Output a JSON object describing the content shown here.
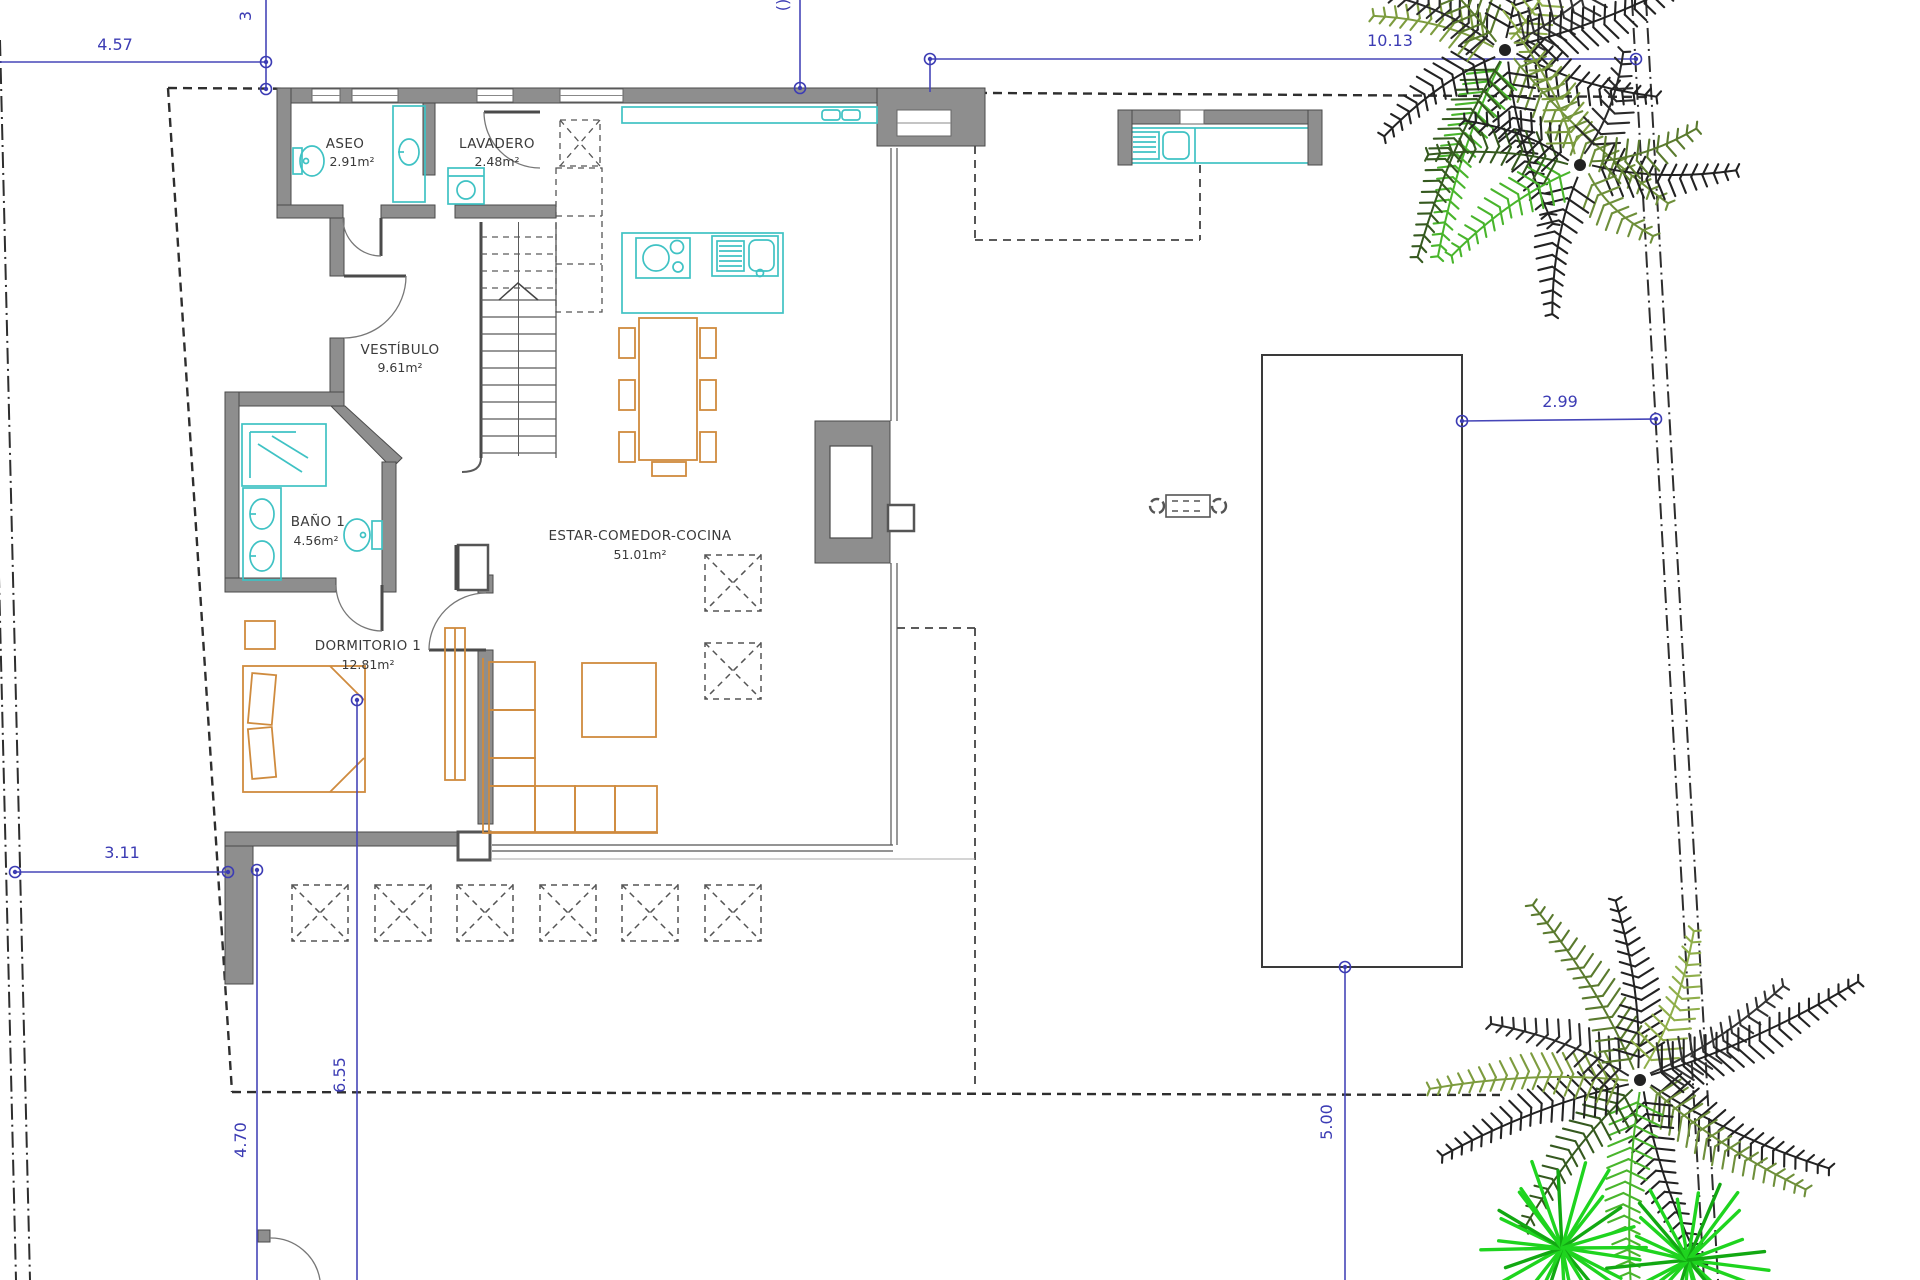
{
  "drawing": {
    "kind": "architectural floor plan",
    "floor": "ground floor villa with plot, terrace and pool"
  },
  "rooms": {
    "aseo": {
      "name": "ASEO",
      "area": "2.91m²"
    },
    "lavadero": {
      "name": "LAVADERO",
      "area": "2.48m²"
    },
    "vestibulo": {
      "name": "VESTÍBULO",
      "area": "9.61m²"
    },
    "bano1": {
      "name": "BAÑO 1",
      "area": "4.56m²"
    },
    "dormitorio1": {
      "name": "DORMITORIO 1",
      "area": "12.81m²"
    },
    "estar": {
      "name": "ESTAR-COMEDOR-COCINA",
      "area": "51.01m²"
    }
  },
  "dimensions": {
    "front_width": "4.57",
    "front_side": "3",
    "rear_width": "10.13",
    "pool_to_boundary": "2.99",
    "side_setback": "3.11",
    "terrace_depth": "6.55",
    "front_setback": "4.70",
    "pool_side": "5.00"
  },
  "colors": {
    "wall_gray": "#8e8e8e",
    "wall_edge": "#4a4a4a",
    "dimension_blue": "#3c3cb4",
    "fixture_cyan": "#3fc2c4",
    "furniture_orange": "#cf8b3e",
    "boundary_dark": "#2e2e2e",
    "palm_dark": "#222222",
    "palm_olive": "#6e8f3a",
    "palm_green": "#49b52c",
    "shrub_green": "#1fd41f"
  },
  "palms": {
    "top_a": {
      "cx": 1505,
      "cy": 50,
      "fronds": 13,
      "min": 130,
      "max": 225
    },
    "top_b": {
      "cx": 1580,
      "cy": 165,
      "fronds": 9,
      "min": 100,
      "max": 170
    },
    "bottom": {
      "cx": 1640,
      "cy": 1080,
      "fronds": 13,
      "min": 150,
      "max": 255
    },
    "shrub1": {
      "cx": 1562,
      "cy": 1248,
      "rays": 26,
      "r": 85
    },
    "shrub2": {
      "cx": 1688,
      "cy": 1260,
      "rays": 24,
      "r": 78
    }
  }
}
